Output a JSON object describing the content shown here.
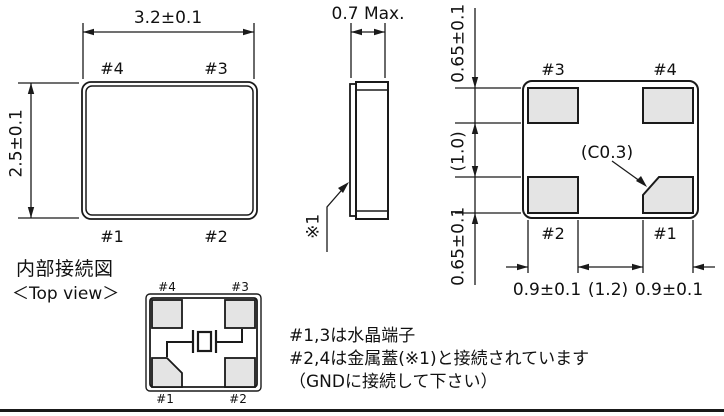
{
  "colors": {
    "line": "#1a1a1a",
    "pad_fill": "#e4e4e4",
    "bg": "#ffffff"
  },
  "top_view": {
    "dim_width": "3.2±0.1",
    "dim_height": "2.5±0.1",
    "pad_top_left": "#4",
    "pad_top_right": "#3",
    "pad_bottom_left": "#1",
    "pad_bottom_right": "#2"
  },
  "side_view": {
    "dim_thickness": "0.7 Max.",
    "lid_ref": "※1"
  },
  "bottom_view": {
    "dim_pad_top": "0.65±0.1",
    "dim_gap_v": "(1.0)",
    "dim_pad_bottom": "0.65±0.1",
    "pad_top_left": "#3",
    "pad_top_right": "#4",
    "pad_bottom_left": "#2",
    "pad_bottom_right": "#1",
    "chamfer": "(C0.3)",
    "dim_pad_left": "0.9±0.1",
    "dim_gap_h": "(1.2)",
    "dim_pad_right": "0.9±0.1"
  },
  "internal": {
    "title": "内部接続図",
    "subtitle": "＜Top view＞",
    "pad_top_left": "#4",
    "pad_top_right": "#3",
    "pad_bottom_left": "#1",
    "pad_bottom_right": "#2"
  },
  "notes": {
    "line1": "#1,3は水晶端子",
    "line2": "#2,4は金属蓋(※1)と接続されています",
    "line3": "（GNDに接続して下さい）"
  }
}
